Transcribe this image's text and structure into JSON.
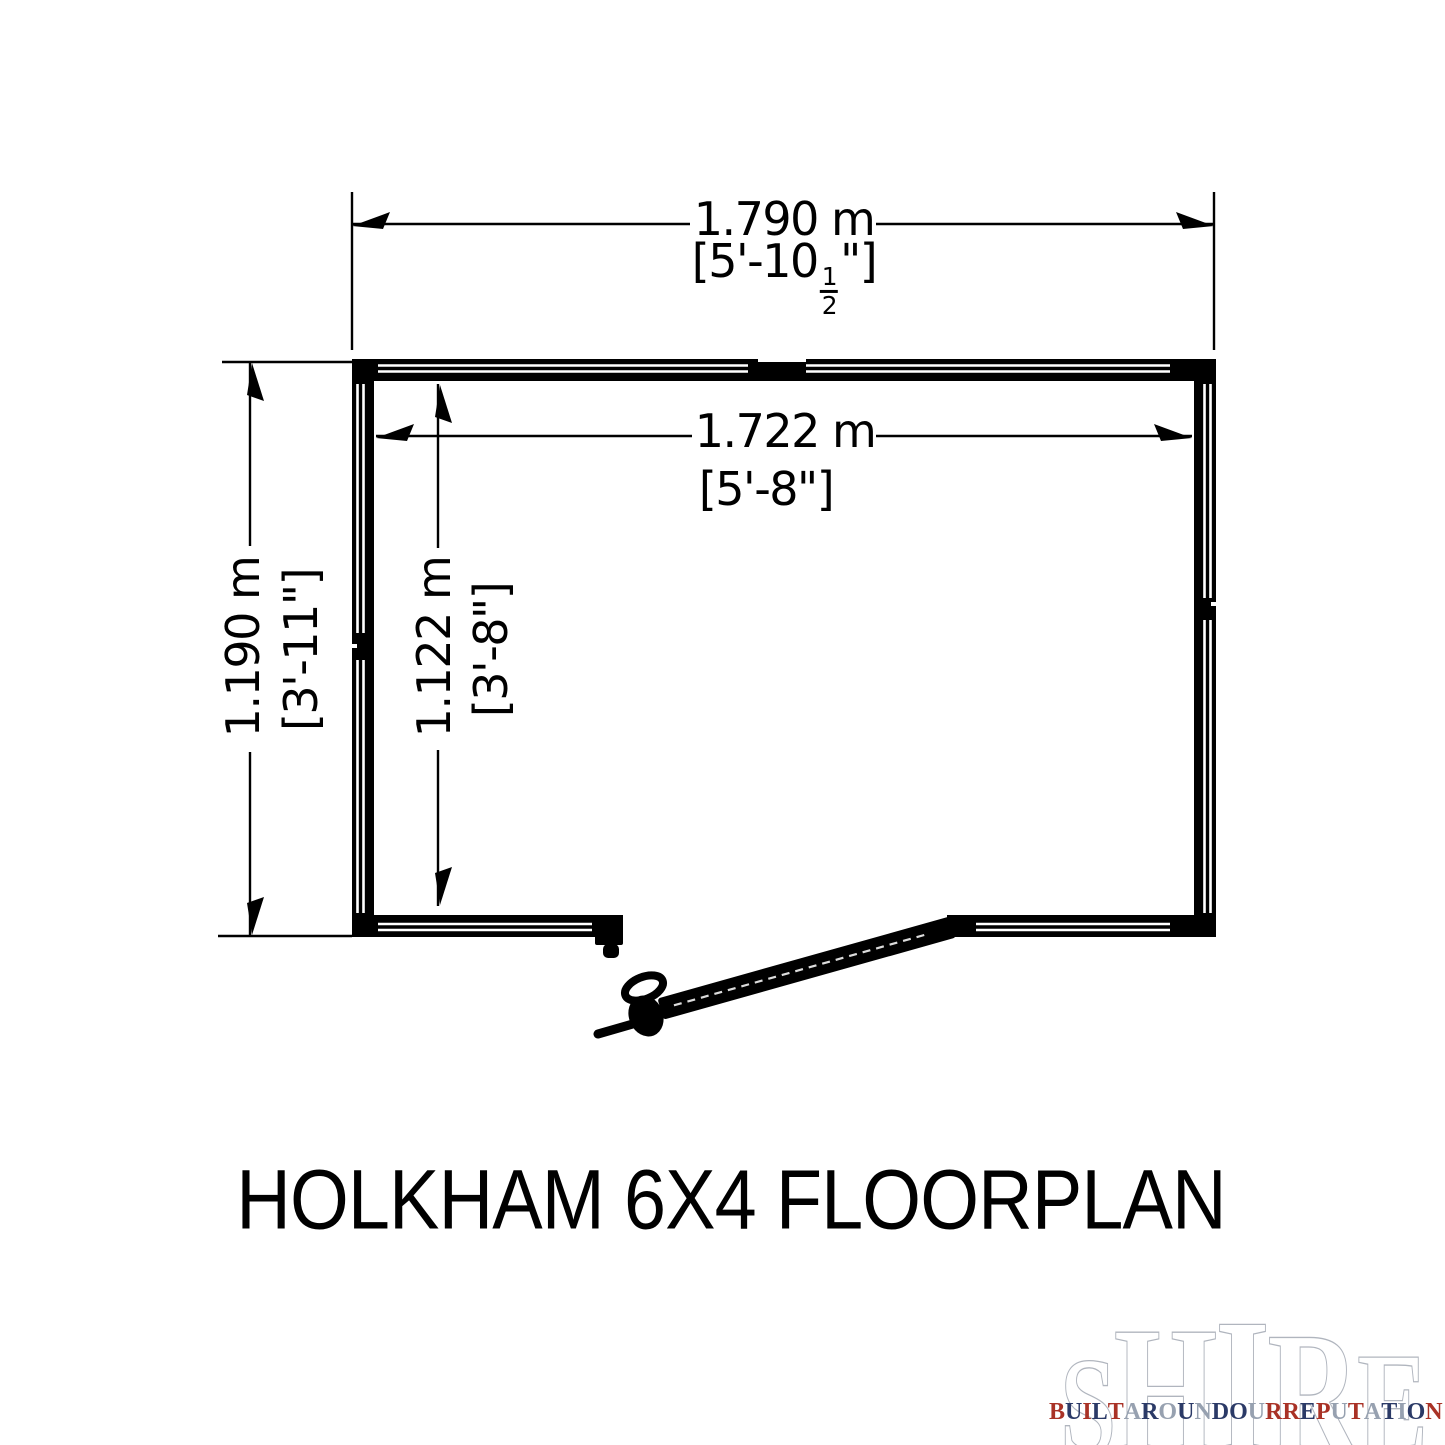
{
  "page": {
    "background": "#ffffff",
    "ink": "#000000"
  },
  "title": "HOLKHAM 6X4 FLOORPLAN",
  "floorplan": {
    "dimensions": {
      "outer_width": {
        "metric": "1.790 m",
        "imperial_prefix": "[5'-10",
        "imperial_frac_num": "1",
        "imperial_frac_den": "2",
        "imperial_suffix": "\"]"
      },
      "inner_width": {
        "metric": "1.722 m",
        "imperial": "[5'-8\"]"
      },
      "outer_depth": {
        "metric": "1.190 m",
        "imperial": "[3'-11\"]"
      },
      "inner_depth": {
        "metric": "1.122 m",
        "imperial": "[3'-8\"]"
      }
    },
    "features": [
      "door-opening-bottom",
      "open-door-leaf",
      "door-handle",
      "door-stop"
    ]
  },
  "logo": {
    "brand": "SHIRE",
    "tagline": "BUILT AROUND OUR REPUTATION",
    "palette": {
      "red": "#a93226",
      "navy": "#2b3a67",
      "silver": "#97a1b0"
    },
    "tagline_color_map": "0,1,0,1,0,2,1,2,1,2,1,1,2,0,0,1,0,2,0,2,1,2,1,0"
  }
}
